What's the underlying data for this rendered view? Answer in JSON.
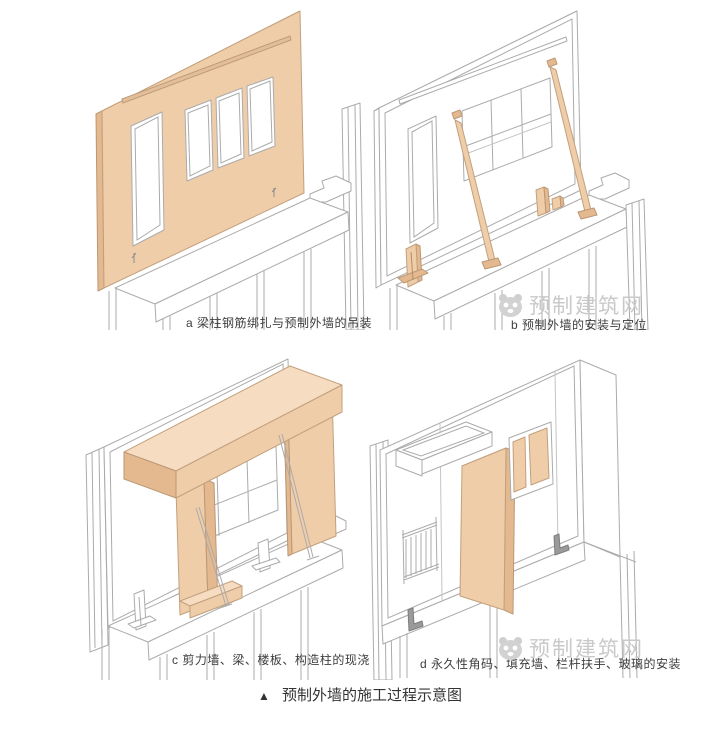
{
  "figure": {
    "panels": [
      {
        "key": "a",
        "caption": "a 梁柱钢筋绑扎与预制外墙的吊装"
      },
      {
        "key": "b",
        "caption": "b 预制外墙的安装与定位"
      },
      {
        "key": "c",
        "caption": "c 剪力墙、梁、楼板、构造柱的现浇"
      },
      {
        "key": "d",
        "caption": "d 永久性角码、填充墙、栏杆扶手、玻璃的安装"
      }
    ],
    "watermark": {
      "text": "预制建筑网",
      "logo": "panda-icon"
    },
    "footer": {
      "marker": "▲",
      "caption": "预制外墙的施工过程示意图"
    }
  },
  "colors": {
    "background": "#ffffff",
    "precast_fill": "#f0cda9",
    "precast_fill_light": "#f6dcc1",
    "precast_fill_dark": "#e4b98f",
    "outline": "#ababab",
    "caption_text": "#3d3d3d",
    "footer_text": "#333333",
    "watermark_text": "#c9c9c9"
  }
}
